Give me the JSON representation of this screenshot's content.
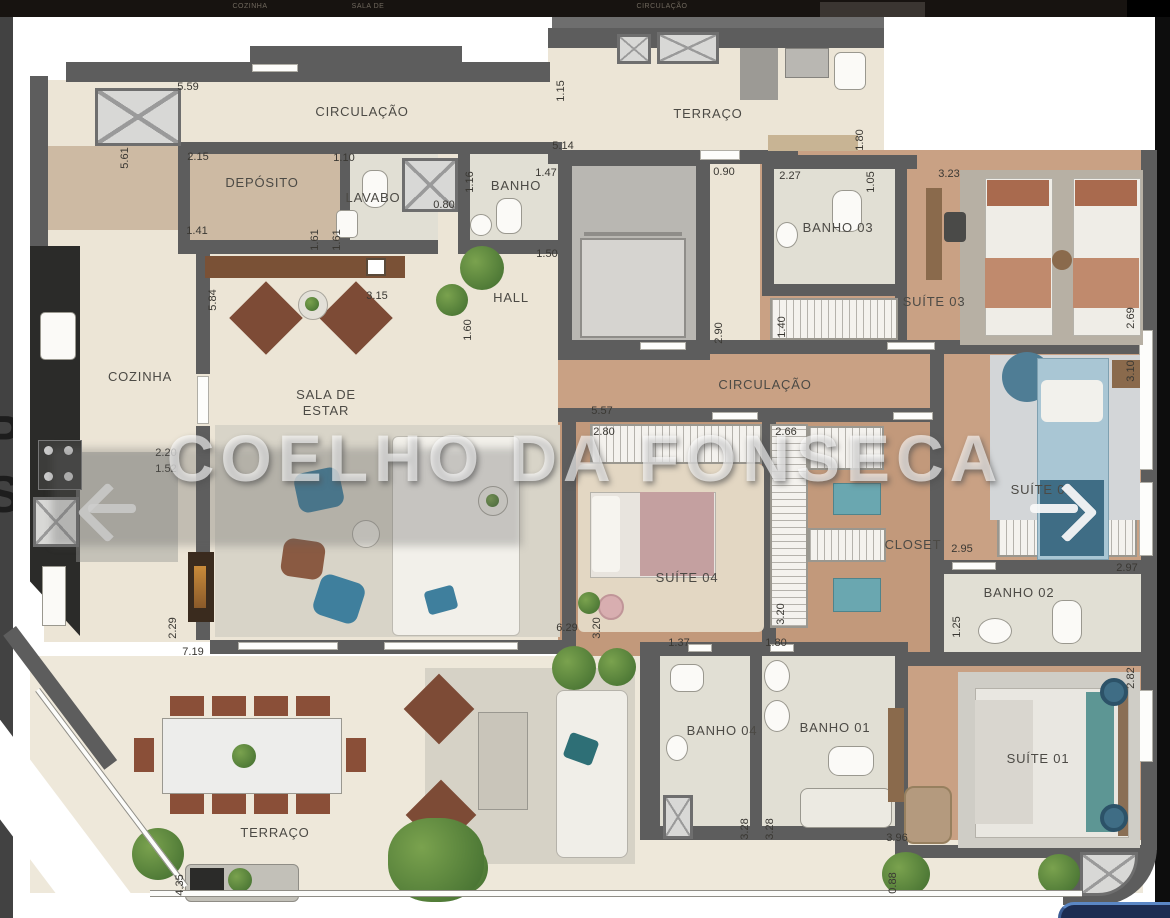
{
  "watermark": {
    "text": "COELHO DA FONSECA"
  },
  "edge_letters": {
    "letters": [
      "P",
      "S"
    ]
  },
  "top_strip": {
    "labels": [
      {
        "text": "COZINHA",
        "x": 250
      },
      {
        "text": "SALA DE",
        "x": 368
      },
      {
        "text": "CIRCULAÇÃO",
        "x": 662
      }
    ]
  },
  "rooms": [
    {
      "id": "circulacao-top",
      "label": "CIRCULAÇÃO",
      "x": 362,
      "y": 112
    },
    {
      "id": "deposito",
      "label": "DEPÓSITO",
      "x": 262,
      "y": 183
    },
    {
      "id": "lavabo",
      "label": "LAVABO",
      "x": 373,
      "y": 198
    },
    {
      "id": "banho-social",
      "label": "BANHO",
      "x": 516,
      "y": 186
    },
    {
      "id": "hall",
      "label": "HALL",
      "x": 511,
      "y": 298
    },
    {
      "id": "terraco-superior",
      "label": "TERRAÇO",
      "x": 708,
      "y": 114
    },
    {
      "id": "banho-03",
      "label": "BANHO 03",
      "x": 838,
      "y": 228
    },
    {
      "id": "suite-03",
      "label": "SUÍTE 03",
      "x": 934,
      "y": 302
    },
    {
      "id": "cozinha",
      "label": "COZINHA",
      "x": 140,
      "y": 377
    },
    {
      "id": "sala-de-estar",
      "label": "SALA DE\nESTAR",
      "x": 326,
      "y": 403
    },
    {
      "id": "circulacao-mid",
      "label": "CIRCULAÇÃO",
      "x": 765,
      "y": 385
    },
    {
      "id": "suite-04",
      "label": "SUÍTE 04",
      "x": 687,
      "y": 578
    },
    {
      "id": "closet",
      "label": "CLOSET",
      "x": 913,
      "y": 545
    },
    {
      "id": "suite-02",
      "label": "SUÍTE 02",
      "x": 1042,
      "y": 490
    },
    {
      "id": "banho-02",
      "label": "BANHO 02",
      "x": 1019,
      "y": 593
    },
    {
      "id": "banho-04",
      "label": "BANHO 04",
      "x": 722,
      "y": 731
    },
    {
      "id": "banho-01",
      "label": "BANHO 01",
      "x": 835,
      "y": 728
    },
    {
      "id": "suite-01",
      "label": "SUÍTE 01",
      "x": 1038,
      "y": 759
    },
    {
      "id": "terraco",
      "label": "TERRAÇO",
      "x": 275,
      "y": 833
    }
  ],
  "dimensions": [
    {
      "value": "5.59",
      "x": 188,
      "y": 87
    },
    {
      "value": "2.15",
      "x": 198,
      "y": 157
    },
    {
      "value": "1.10",
      "x": 344,
      "y": 158
    },
    {
      "value": "1.41",
      "x": 197,
      "y": 231
    },
    {
      "value": "1.61",
      "x": 315,
      "y": 240,
      "vertical": true
    },
    {
      "value": "1.61",
      "x": 337,
      "y": 240,
      "vertical": true
    },
    {
      "value": "5.84",
      "x": 213,
      "y": 300,
      "vertical": true
    },
    {
      "value": "3.15",
      "x": 377,
      "y": 296
    },
    {
      "value": "0.80",
      "x": 444,
      "y": 205
    },
    {
      "value": "1.16",
      "x": 470,
      "y": 182,
      "vertical": true
    },
    {
      "value": "1.47",
      "x": 546,
      "y": 173
    },
    {
      "value": "5.14",
      "x": 563,
      "y": 146
    },
    {
      "value": "1.15",
      "x": 561,
      "y": 91,
      "vertical": true
    },
    {
      "value": "1.50",
      "x": 547,
      "y": 254
    },
    {
      "value": "1.60",
      "x": 468,
      "y": 330,
      "vertical": true
    },
    {
      "value": "0.90",
      "x": 724,
      "y": 172
    },
    {
      "value": "2.90",
      "x": 719,
      "y": 333,
      "vertical": true
    },
    {
      "value": "1.80",
      "x": 860,
      "y": 140,
      "vertical": true
    },
    {
      "value": "2.27",
      "x": 790,
      "y": 176
    },
    {
      "value": "1.05",
      "x": 871,
      "y": 182,
      "vertical": true
    },
    {
      "value": "3.23",
      "x": 949,
      "y": 174
    },
    {
      "value": "2.69",
      "x": 1131,
      "y": 318,
      "vertical": true
    },
    {
      "value": "1.40",
      "x": 782,
      "y": 327,
      "vertical": true
    },
    {
      "value": "3.10",
      "x": 1131,
      "y": 371,
      "vertical": true
    },
    {
      "value": "5.61",
      "x": 125,
      "y": 158,
      "vertical": true
    },
    {
      "value": "5.57",
      "x": 602,
      "y": 411
    },
    {
      "value": "2.80",
      "x": 604,
      "y": 432
    },
    {
      "value": "2.66",
      "x": 786,
      "y": 432
    },
    {
      "value": "2.20",
      "x": 166,
      "y": 453
    },
    {
      "value": "1.52",
      "x": 166,
      "y": 469
    },
    {
      "value": "2.95",
      "x": 962,
      "y": 549
    },
    {
      "value": "2.97",
      "x": 1127,
      "y": 568
    },
    {
      "value": "1.25",
      "x": 957,
      "y": 627,
      "vertical": true
    },
    {
      "value": "3.20",
      "x": 781,
      "y": 614,
      "vertical": true
    },
    {
      "value": "3.20",
      "x": 597,
      "y": 628,
      "vertical": true
    },
    {
      "value": "6.29",
      "x": 567,
      "y": 628
    },
    {
      "value": "2.29",
      "x": 173,
      "y": 628,
      "vertical": true
    },
    {
      "value": "7.19",
      "x": 193,
      "y": 652
    },
    {
      "value": "1.37",
      "x": 679,
      "y": 643
    },
    {
      "value": "1.80",
      "x": 776,
      "y": 643
    },
    {
      "value": "3.28",
      "x": 745,
      "y": 829,
      "vertical": true
    },
    {
      "value": "3.28",
      "x": 770,
      "y": 829,
      "vertical": true
    },
    {
      "value": "3.96",
      "x": 897,
      "y": 838
    },
    {
      "value": "0.88",
      "x": 893,
      "y": 883,
      "vertical": true
    },
    {
      "value": "2.82",
      "x": 1131,
      "y": 678,
      "vertical": true
    },
    {
      "value": "4.35",
      "x": 180,
      "y": 885,
      "vertical": true
    }
  ],
  "colors": {
    "wall": "#5d5d5d",
    "floor_main": "#ece5d6",
    "floor_wood": "#c9a184",
    "floor_tile": "#e1dfd4",
    "counter_dark": "#2b2b29",
    "ui_pill_blue": "#1d2d52"
  }
}
